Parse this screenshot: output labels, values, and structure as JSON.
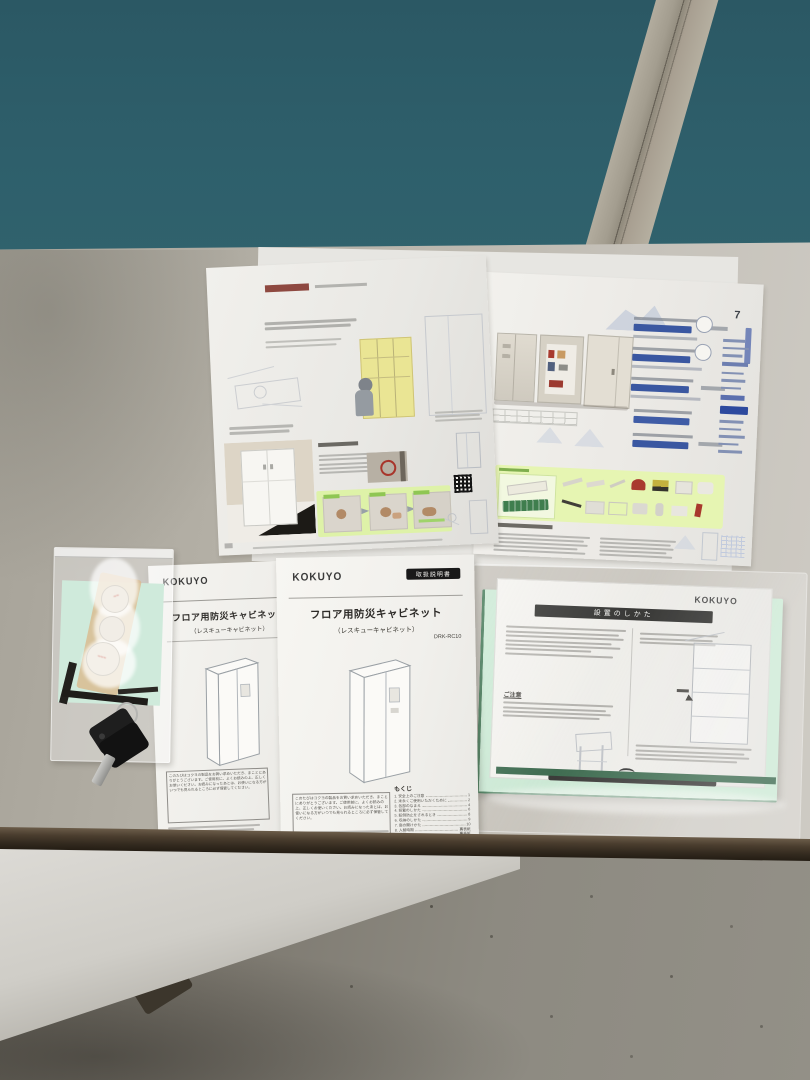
{
  "manual": {
    "logo": "KOKUYO",
    "badge": "取扱説明書",
    "title": "フロア用防災キャビネット",
    "subtitle": "（レスキューキャビネット）",
    "model": "DRK-RC10",
    "notice": "このたびはコクヨの製品をお買い求めいただき、まことにありがとうございます。ご使用前に、よくお読みの上、正しくお使いください。お読みになったあとは、お使いになる方がいつでも見られるところに必ず保管してください。",
    "toc_heading": "もくじ",
    "toc": [
      {
        "label": "1. 安全上のご注意",
        "page": "1"
      },
      {
        "label": "2. 末永くご使用いただくために",
        "page": "2"
      },
      {
        "label": "3. 各部のなまえ",
        "page": "4"
      },
      {
        "label": "4. 設置のしかた",
        "page": "6"
      },
      {
        "label": "5. 転倒防止をされるとき",
        "page": "8"
      },
      {
        "label": "6. 収納のしかた",
        "page": "9"
      },
      {
        "label": "7. 扉の開けかた",
        "page": "10"
      },
      {
        "label": "8. 入替時期",
        "page": "裏表紙"
      },
      {
        "label": "9. 仕様",
        "page": "裏表紙"
      }
    ]
  },
  "install_sheet": {
    "logo": "KOKUYO",
    "title": "設置のしかた",
    "caution_label": "ご注意"
  },
  "catalog": {
    "page_number": "7"
  },
  "colors": {
    "partition_teal": "#2e5f6b",
    "table_gray": "#bdb9b0",
    "highlight_green": "#e6f5b2",
    "price_bar_blue": "#3a57a1",
    "badge_black": "#191919",
    "backing_board_green": "#c8e8d2"
  }
}
